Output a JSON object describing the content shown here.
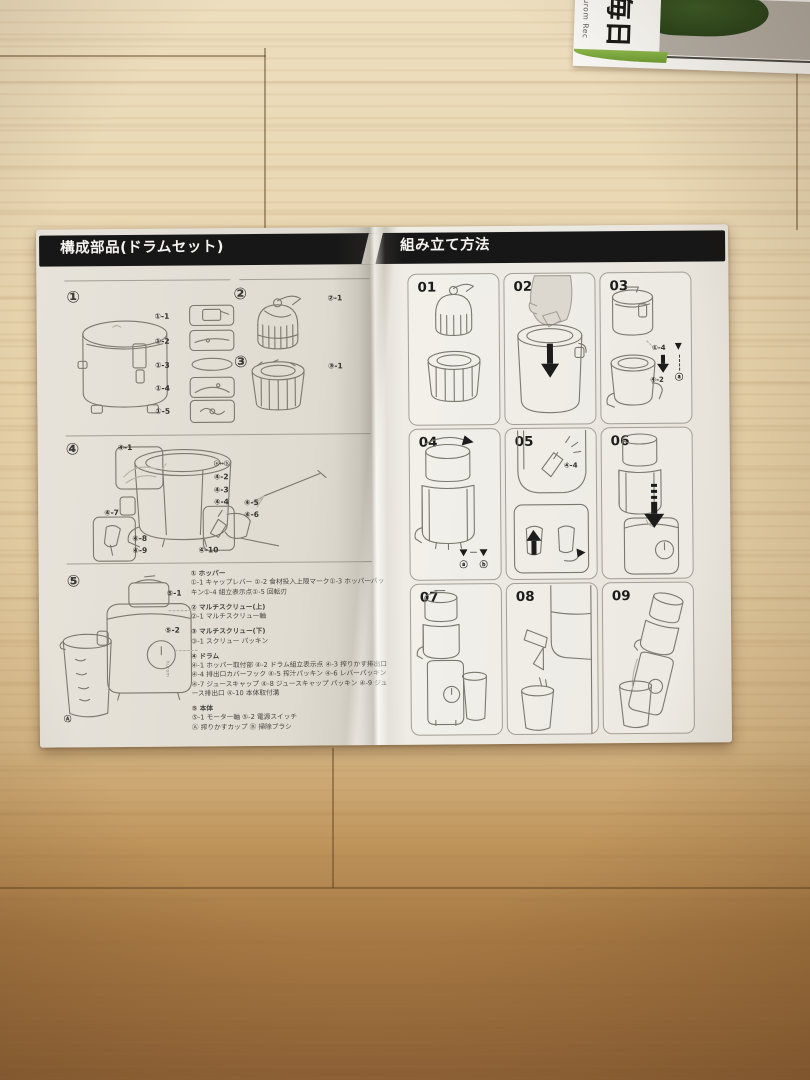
{
  "scene": {
    "floor": {
      "top_color": "#eddebf",
      "bottom_color": "#926538"
    },
    "recipe_booklet": {
      "small_vertical_text": "Hurom Rec",
      "large_vertical_text": "毎日",
      "accent_green": "#7fae3f"
    }
  },
  "manual": {
    "left_page": {
      "title": "構成部品(ドラムセット)",
      "sections": {
        "s1": {
          "num": "①",
          "labels": [
            "①-1",
            "①-2",
            "①-3",
            "①-4",
            "①-5"
          ]
        },
        "s2": {
          "num": "②",
          "label": "②-1"
        },
        "s3": {
          "num": "③",
          "label": "③-1"
        },
        "s4": {
          "num": "④",
          "l1": "④-1",
          "ab": "ⓐ↔ⓑ",
          "l2": "④-2",
          "l3": "④-3",
          "l4": "④-4",
          "l5": "④-5",
          "l6": "④-6",
          "l7": "④-7",
          "l8": "④-8",
          "l9": "④-9",
          "l10": "④-10"
        },
        "s5": {
          "num": "⑤",
          "l1": "⑤-1",
          "l2": "⑤-2",
          "cup": "Ⓐ",
          "brand": "hurom"
        }
      },
      "parts_list": [
        {
          "heading": "① ホッパー",
          "detail": "①-1 キャップレバー ①-2 食材投入上限マーク①-3 ホッパーパッキン①-4 組立表示点①-5 回転刃",
          "detail2": ""
        },
        {
          "heading": "② マルチスクリュー(上)",
          "detail": "②-1 マルチスクリュー軸",
          "detail2": ""
        },
        {
          "heading": "③ マルチスクリュー(下)",
          "detail": "③-1 スクリュー パッキン",
          "detail2": ""
        },
        {
          "heading": "④ ドラム",
          "detail": "④-1 ホッパー取付部 ④-2 ドラム組立表示点 ④-3 搾りかす排出口 ④-4 排出口カバーフック ④-5 搾汁パッキン ④-6 レバーパッキン ④-7 ジュースキャップ ④-8 ジュースキャップ パッキン ④-9 ジュース排出口 ④-10 本体取付溝",
          "detail2": ""
        },
        {
          "heading": "⑤ 本体",
          "detail": "⑤-1 モーター軸 ⑤-2 電源スイッチ",
          "detail2": "Ⓐ 搾りかすカップ Ⓑ 掃除ブラシ"
        }
      ]
    },
    "right_page": {
      "title": "組み立て方法",
      "steps": [
        {
          "num": "01"
        },
        {
          "num": "02"
        },
        {
          "num": "03",
          "callout_top": "①-4",
          "callout_bottom": "④-2",
          "mark": "ⓐ",
          "tri": "▼"
        },
        {
          "num": "04",
          "mark_a": "ⓐ",
          "mark_b": "ⓑ",
          "tri": "▼",
          "tri2": "▼"
        },
        {
          "num": "05",
          "callout": "④-4"
        },
        {
          "num": "06"
        },
        {
          "num": "07"
        },
        {
          "num": "08"
        },
        {
          "num": "09"
        }
      ]
    }
  }
}
